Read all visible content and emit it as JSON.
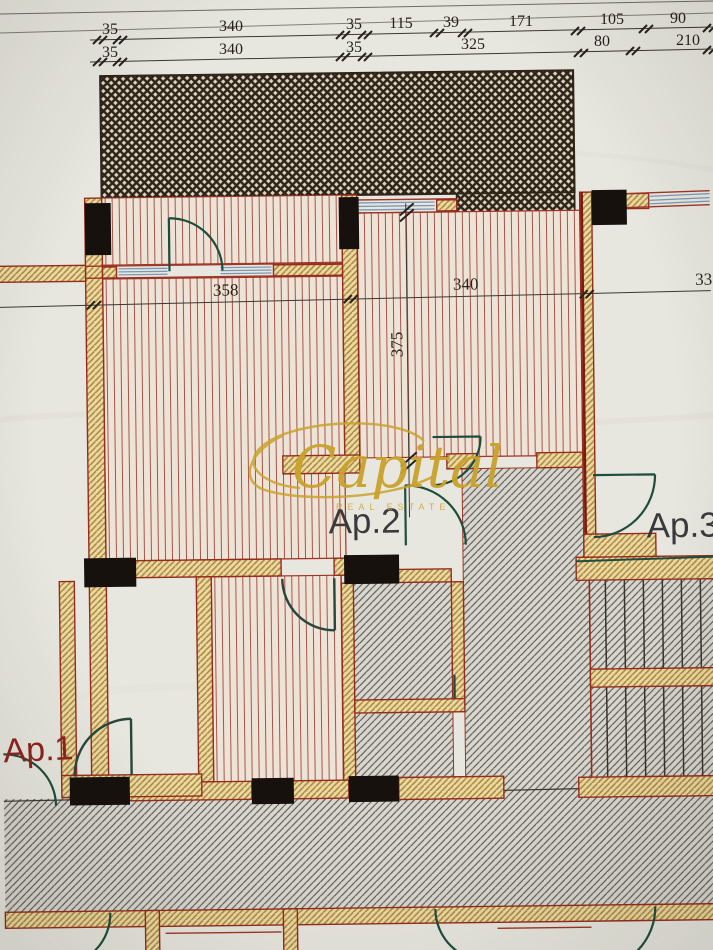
{
  "document": {
    "kind": "architectural floor plan photo",
    "watermark": {
      "brand": "Capital",
      "tagline": "REAL ESTATE",
      "color": "#c9a22b"
    }
  },
  "labels": {
    "apartment_1": "Ap.1",
    "apartment_2": "Ap.2",
    "apartment_3": "Ap.3"
  },
  "dimensions": {
    "top_row_1": [
      "35",
      "340",
      "35",
      "115",
      "39",
      "171",
      "105",
      "90"
    ],
    "top_row_2": [
      "35",
      "340",
      "35",
      "325",
      "80",
      "210"
    ],
    "middle_row": [
      "358",
      "340",
      "33"
    ],
    "vertical": "375"
  },
  "legend": {
    "crosshatch_area": "balcony / projection above",
    "vertical_hatch_area": "apartment rooms",
    "diagonal_hatch_area": "common area and stairs",
    "wall_fill": "masonry walls",
    "black_blocks": "concrete columns",
    "blue_lines": "windows",
    "green_arcs": "door swings"
  },
  "colors": {
    "paper": "#e8e7df",
    "wall_outline_red": "#962c1e",
    "wall_fill_tan": "#eeda9e",
    "room_hatch_line": "#a5564a",
    "common_hatch_line": "#57524a",
    "crosshatch_line": "#2e2318",
    "window_blue": "#7a97b5",
    "door_green": "#1f4d3d",
    "column_black": "#16110d",
    "dimension_text": "#26221c",
    "ap1_red": "#8e241c",
    "watermark_gold": "#c9a22b"
  }
}
